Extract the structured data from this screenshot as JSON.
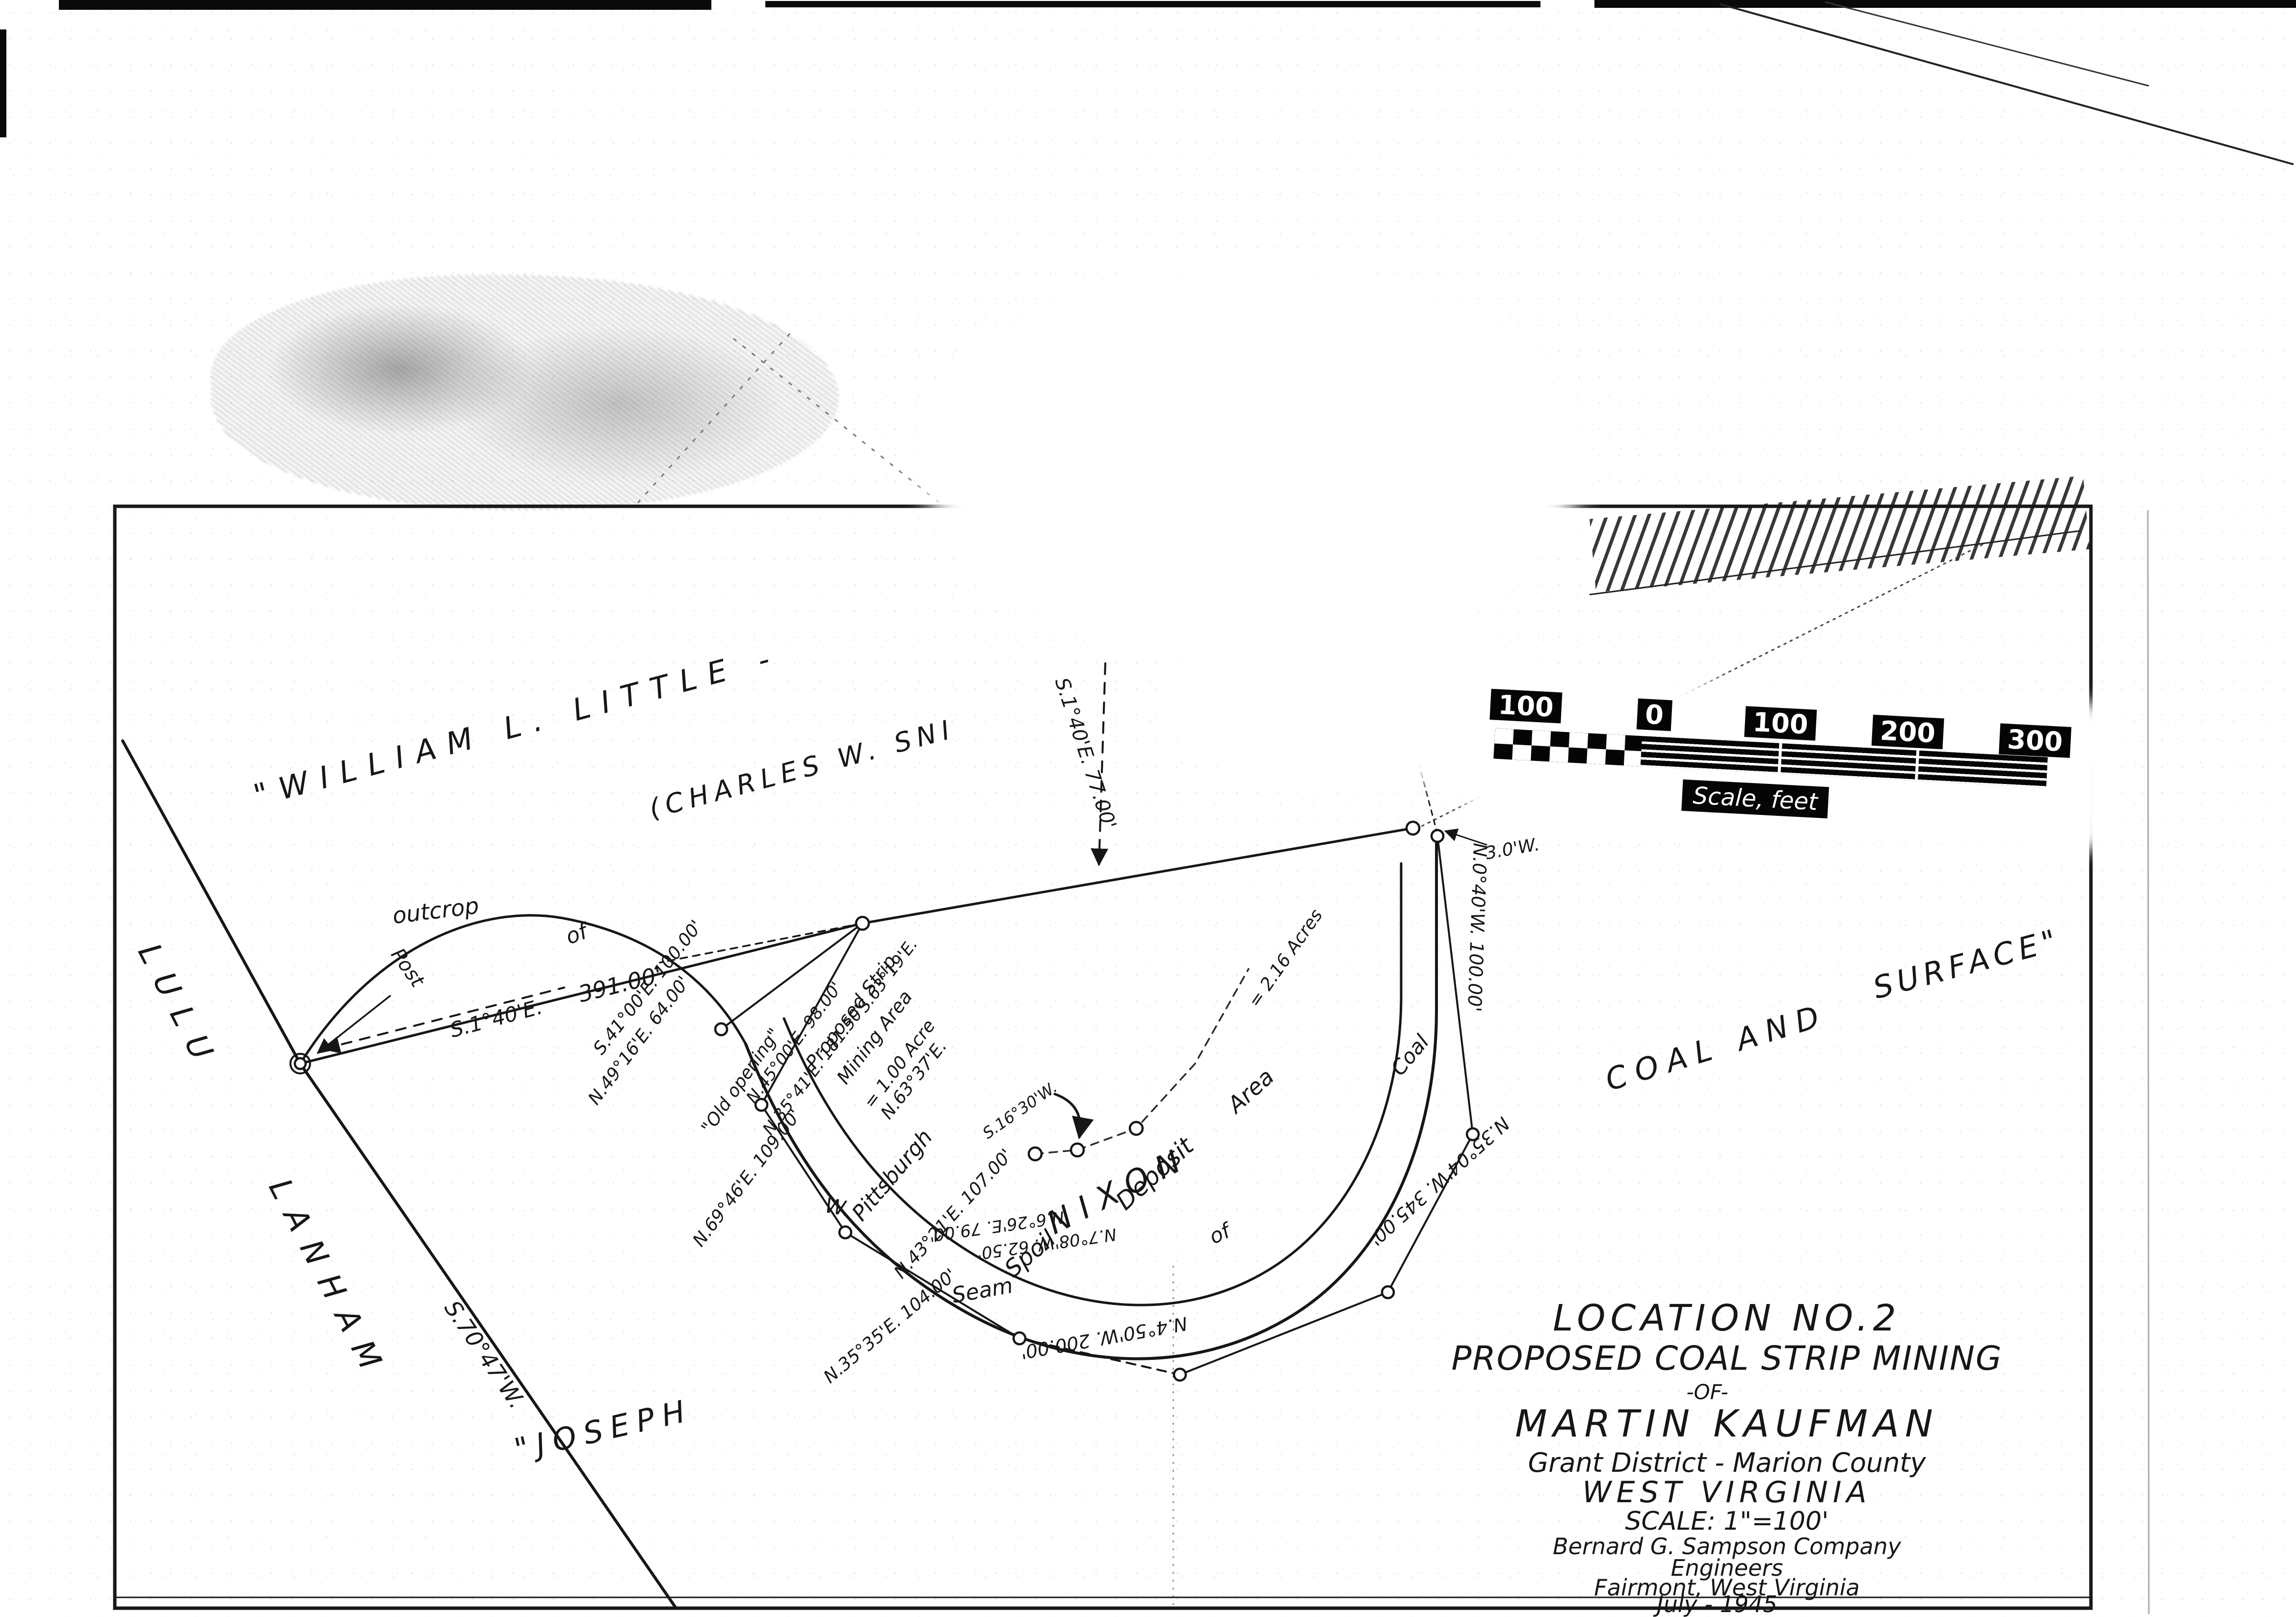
{
  "title_block": {
    "line1": "LOCATION NO.2",
    "line2": "PROPOSED COAL STRIP MINING",
    "line3": "-OF-",
    "line4": "MARTIN KAUFMAN",
    "line5": "Grant District - Marion County",
    "line6": "WEST VIRGINIA",
    "line7": "SCALE: 1\"=100'",
    "line8": "Bernard G. Sampson Company",
    "line9": "Engineers",
    "line10": "Fairmont, West Virginia",
    "line11": "July - 1945"
  },
  "scale_bar": {
    "t1": "100",
    "t2": "0",
    "t3": "100",
    "t4": "200",
    "t5": "300",
    "caption": "Scale, feet"
  },
  "owners": {
    "william": "\"WILLIAM L. LITTLE -",
    "charles": "(CHARLES W. SNI",
    "fragment": "...AGE\"",
    "lulu": "LULU",
    "lanham": "LANHAM",
    "joseph": "\"JOSEPH",
    "nixon": "NIXON",
    "coal_and": "COAL AND",
    "surface": "SURFACE\""
  },
  "features": {
    "outcrop": "outcrop",
    "of1": "of",
    "post": "Post",
    "old_opening": "\"Old opening\"",
    "spring_w": "W.",
    "proposed1": "Proposed Strip",
    "proposed2": "Mining Area",
    "proposed3": "= 1.00 Acre",
    "pittsburgh": "Pittsburgh",
    "seam": "Seam",
    "spoil": "Spoil",
    "deposit": "Deposit",
    "area": "Area",
    "of2": "of",
    "coal": "Coal",
    "acres": "= 2.16 Acres"
  },
  "bearings": {
    "s140_post": "S.1°40'E.",
    "d391": "391.00'",
    "s7047": "S.70°47'W.",
    "s140_77": "S.1°40'E. 77.00'",
    "s4100": "S.41°00'E. 100.00'",
    "n4916": "N.49°16'E. 64.00'",
    "n6946": "N.69°46'E. 109.00'",
    "n4500": "N.45°00'E. 98.00'",
    "n3541": "N.35°41'E. 181.50'",
    "s6319": "S.63°19'E.",
    "n6337": "N.63°37'E.",
    "n4321": "N.43°21'E. 107.00'",
    "n626": "N.6°26'E. 79.00'",
    "n708": "N.7°08'W. 62.50'",
    "n3535": "N.35°35'E. 104.00'",
    "n450": "N.4°50'W. 200.00'",
    "n3504": "N.35°04'W. 345.00'",
    "n040": "N.0°40'W. 100.00'",
    "d30w": "3.0'W.",
    "s1630": "S.16°30'W."
  }
}
